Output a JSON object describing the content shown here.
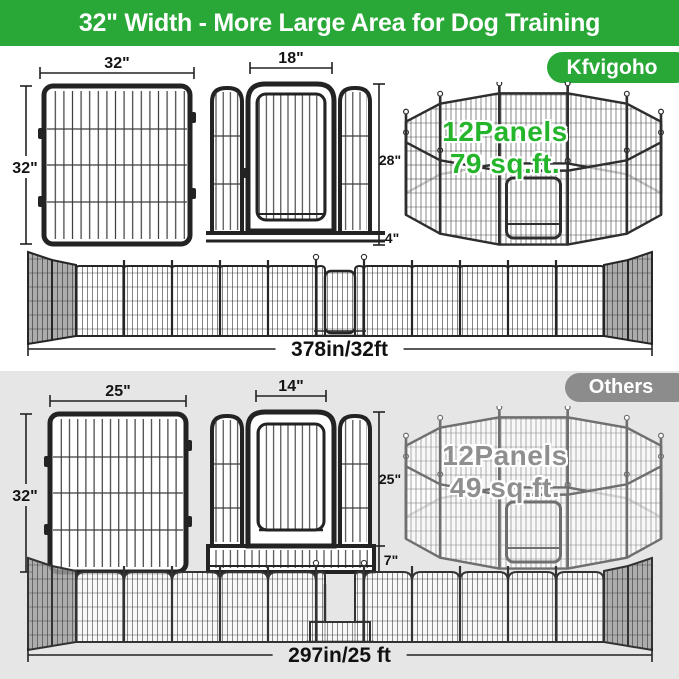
{
  "banner": {
    "title": "32\" Width - More Large Area for Dog Training"
  },
  "kfvigoho": {
    "badge": "Kfvigoho",
    "panel": {
      "width": "32\"",
      "height": "32\""
    },
    "door_panel": {
      "width": "18\"",
      "height": "28\"",
      "bottom": "4\""
    },
    "pen": {
      "panels": "12Panels",
      "area": "79 sq.ft."
    },
    "fence_total": "378in/32ft"
  },
  "others": {
    "badge": "Others",
    "panel": {
      "width": "25\"",
      "height": "32\""
    },
    "door_panel": {
      "width": "14\"",
      "height": "25\"",
      "bottom": "7\""
    },
    "pen": {
      "panels": "12Panels",
      "area": "49 sq.ft."
    },
    "fence_total": "297in/25 ft"
  },
  "colors": {
    "banner_green": "#29a838",
    "accent_green": "#24b52b",
    "others_badge_gray": "#8c8c8c",
    "pen_text_gray": "#8f8f8f",
    "section_gray": "#e6e6e6",
    "fence_dark": "#262626",
    "fence_bottom": "#333333",
    "pen_dark": "#2e2e2e",
    "pen_gray": "#6f6f6f"
  }
}
